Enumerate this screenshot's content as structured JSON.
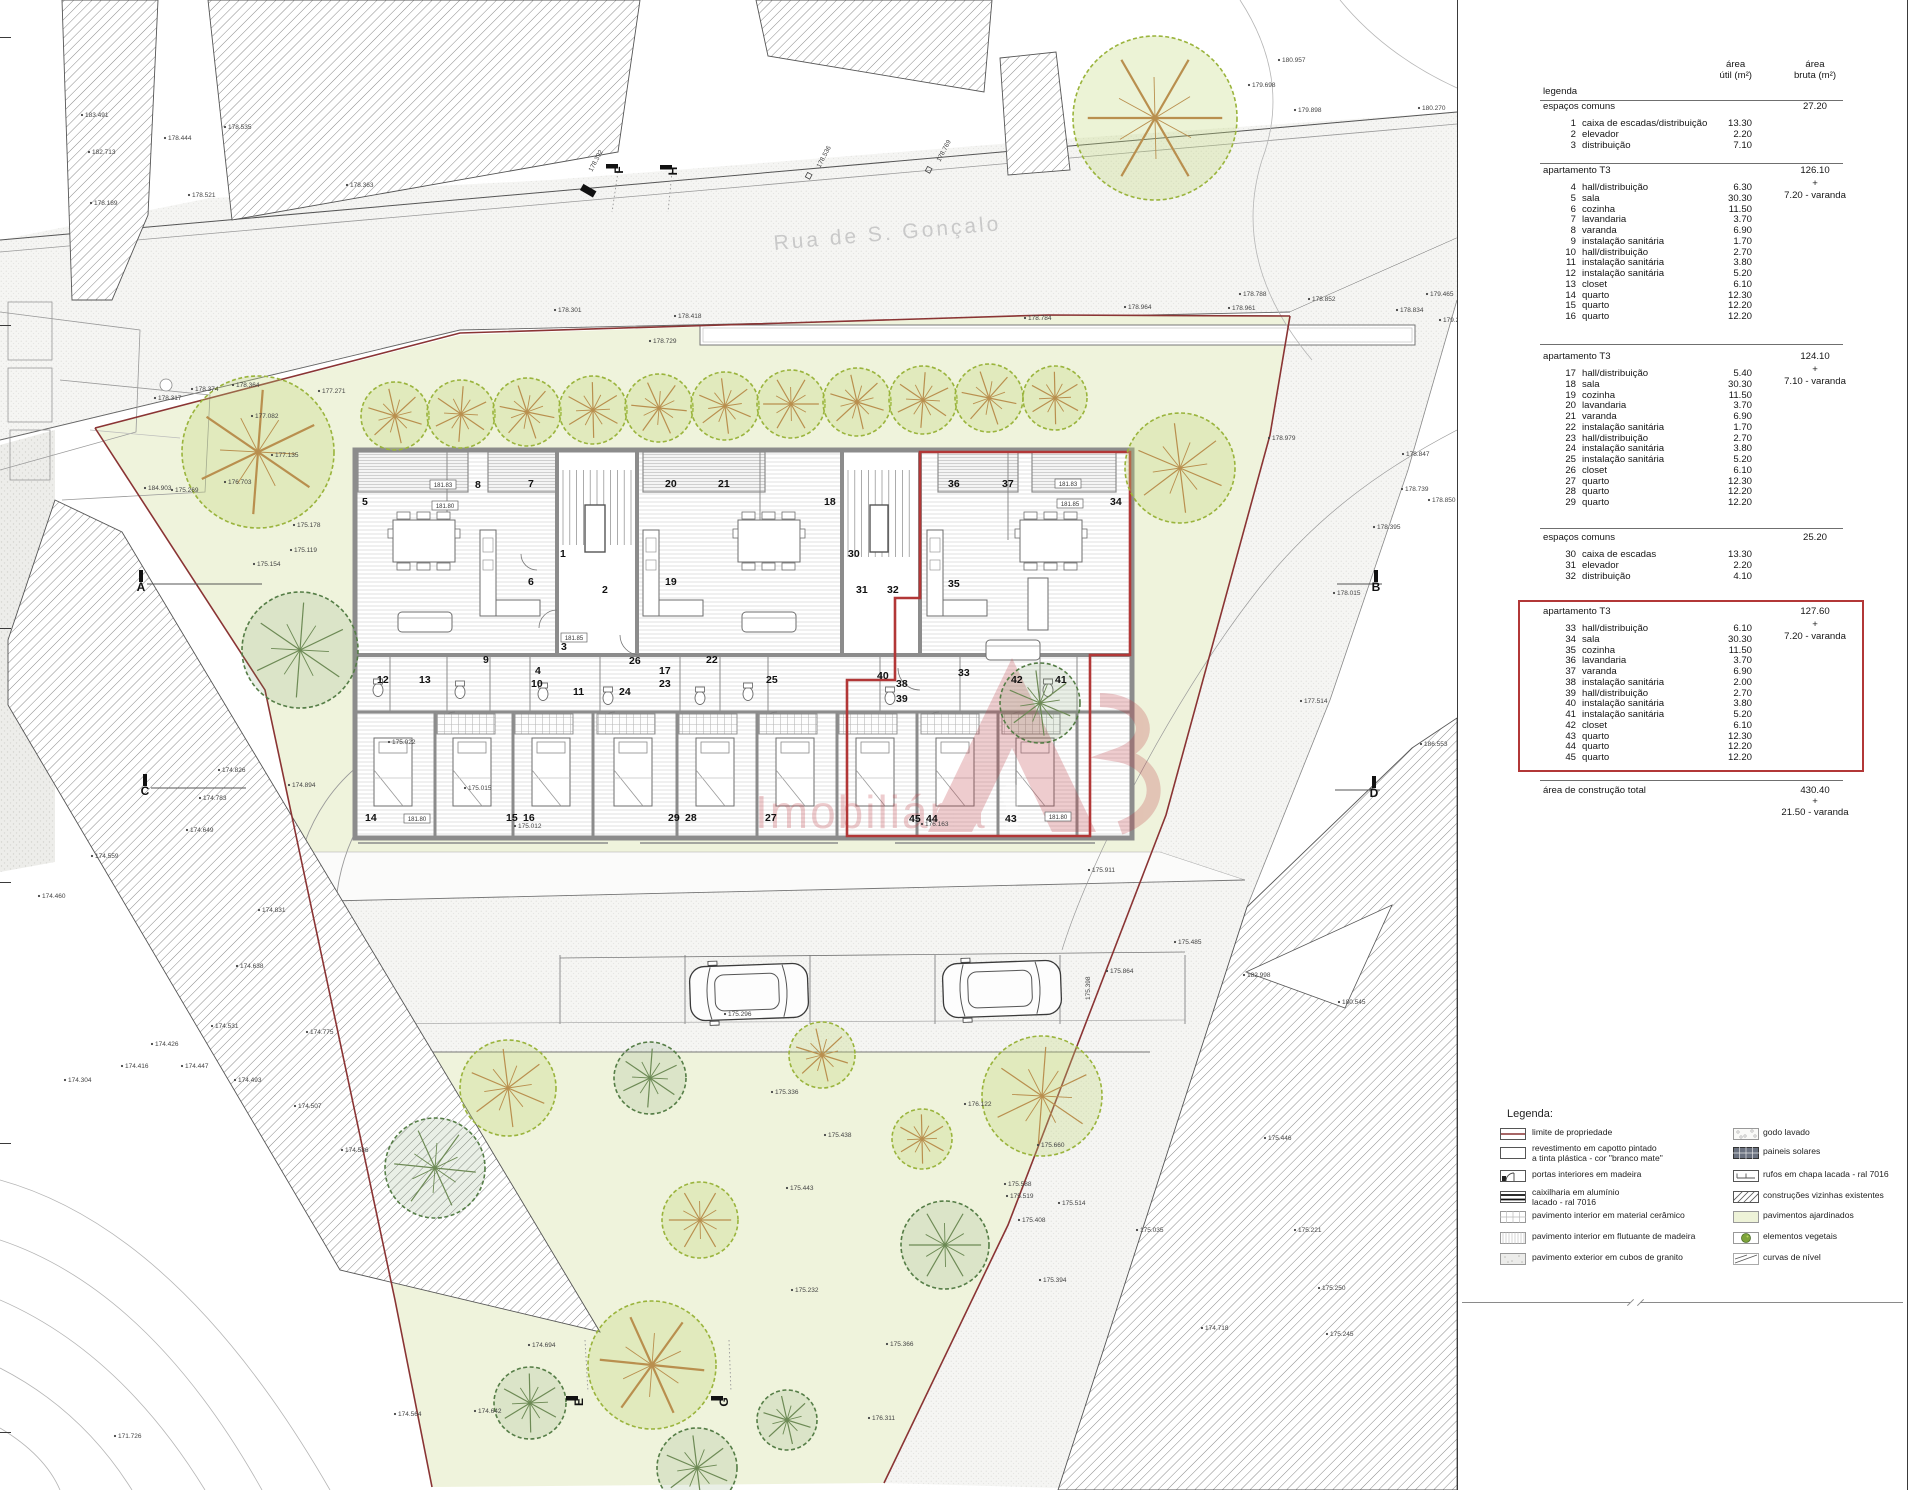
{
  "sheet": {
    "street": "Rua de S. Gonçalo",
    "watermark": "Imobiliária"
  },
  "colors": {
    "property_line": "#8a3434",
    "highlight_red": "#b23737",
    "garden_green": "#eff3dc",
    "tree_light": "#9ab43c",
    "tree_dark": "#557d46",
    "watermark_red": "#bf3d46",
    "street_gray": "#c9c9c9"
  },
  "table": {
    "title": "legenda",
    "col_util_1": "área",
    "col_util_2": "útil (m²)",
    "col_bruta_1": "área",
    "col_bruta_2": "bruta (m²)",
    "sections": [
      {
        "heading": "espaços comuns",
        "bruta": "27.20",
        "plus": "",
        "extra": "",
        "rows": [
          [
            1,
            "caixa de escadas/distribuição",
            "13.30"
          ],
          [
            2,
            "elevador",
            "2.20"
          ],
          [
            3,
            "distribuição",
            "7.10"
          ]
        ]
      },
      {
        "heading": "apartamento T3",
        "bruta": "126.10",
        "plus": "+",
        "extra": "7.20 - varanda",
        "rows": [
          [
            4,
            "hall/distribuição",
            "6.30"
          ],
          [
            5,
            "sala",
            "30.30"
          ],
          [
            6,
            "cozinha",
            "11.50"
          ],
          [
            7,
            "lavandaria",
            "3.70"
          ],
          [
            8,
            "varanda",
            "6.90"
          ],
          [
            9,
            "instalação sanitária",
            "1.70"
          ],
          [
            10,
            "hall/distribuição",
            "2.70"
          ],
          [
            11,
            "instalação sanitária",
            "3.80"
          ],
          [
            12,
            "instalação sanitária",
            "5.20"
          ],
          [
            13,
            "closet",
            "6.10"
          ],
          [
            14,
            "quarto",
            "12.30"
          ],
          [
            15,
            "quarto",
            "12.20"
          ],
          [
            16,
            "quarto",
            "12.20"
          ]
        ]
      },
      {
        "heading": "apartamento T3",
        "bruta": "124.10",
        "plus": "+",
        "extra": "7.10 - varanda",
        "rows": [
          [
            17,
            "hall/distribuição",
            "5.40"
          ],
          [
            18,
            "sala",
            "30.30"
          ],
          [
            19,
            "cozinha",
            "11.50"
          ],
          [
            20,
            "lavandaria",
            "3.70"
          ],
          [
            21,
            "varanda",
            "6.90"
          ],
          [
            22,
            "instalação sanitária",
            "1.70"
          ],
          [
            23,
            "hall/distribuição",
            "2.70"
          ],
          [
            24,
            "instalação sanitária",
            "3.80"
          ],
          [
            25,
            "instalação sanitária",
            "5.20"
          ],
          [
            26,
            "closet",
            "6.10"
          ],
          [
            27,
            "quarto",
            "12.30"
          ],
          [
            28,
            "quarto",
            "12.20"
          ],
          [
            29,
            "quarto",
            "12.20"
          ]
        ]
      },
      {
        "heading": "espaços comuns",
        "bruta": "25.20",
        "plus": "",
        "extra": "",
        "rows": [
          [
            30,
            "caixa de escadas",
            "13.30"
          ],
          [
            31,
            "elevador",
            "2.20"
          ],
          [
            32,
            "distribuição",
            "4.10"
          ]
        ]
      },
      {
        "heading": "apartamento T3",
        "bruta": "127.60",
        "plus": "+",
        "extra": "7.20 - varanda",
        "highlight": true,
        "rows": [
          [
            33,
            "hall/distribuição",
            "6.10"
          ],
          [
            34,
            "sala",
            "30.30"
          ],
          [
            35,
            "cozinha",
            "11.50"
          ],
          [
            36,
            "lavandaria",
            "3.70"
          ],
          [
            37,
            "varanda",
            "6.90"
          ],
          [
            38,
            "instalação sanitária",
            "2.00"
          ],
          [
            39,
            "hall/distribuição",
            "2.70"
          ],
          [
            40,
            "instalação sanitária",
            "3.80"
          ],
          [
            41,
            "instalação sanitária",
            "5.20"
          ],
          [
            42,
            "closet",
            "6.10"
          ],
          [
            43,
            "quarto",
            "12.30"
          ],
          [
            44,
            "quarto",
            "12.20"
          ],
          [
            45,
            "quarto",
            "12.20"
          ]
        ]
      }
    ],
    "total": {
      "label": "área de construção total",
      "value": "430.40",
      "plus": "+",
      "extra": "21.50 - varanda"
    }
  },
  "legend": {
    "title": "Legenda:",
    "left": [
      [
        "limite",
        "limite de propriedade"
      ],
      [
        "capotto",
        "revestimento em capotto pintado\na tinta plástica - cor \"branco mate\""
      ],
      [
        "portas",
        "portas interiores em madeira"
      ],
      [
        "caixilharia",
        "caixilharia em alumínio\nlacado - ral 7016"
      ],
      [
        "ceramico",
        "pavimento interior em material cerâmico"
      ],
      [
        "flutuante",
        "pavimento interior em flutuante de madeira"
      ],
      [
        "granito",
        "pavimento exterior em cubos de granito"
      ]
    ],
    "right": [
      [
        "godo",
        "godo lavado"
      ],
      [
        "solares",
        "paineis solares"
      ],
      [
        "rufos",
        "rufos em chapa lacada - ral 7016"
      ],
      [
        "construcoes",
        "construções vizinhas existentes"
      ],
      [
        "ajardinados",
        "pavimentos ajardinados"
      ],
      [
        "vegetais",
        "elementos vegetais"
      ],
      [
        "curvas",
        "curvas de nível"
      ]
    ]
  },
  "plan": {
    "rooms": [
      [
        1,
        560,
        557
      ],
      [
        2,
        602,
        593
      ],
      [
        3,
        561,
        650
      ],
      [
        4,
        535,
        674
      ],
      [
        5,
        362,
        505
      ],
      [
        6,
        528,
        585
      ],
      [
        7,
        528,
        487
      ],
      [
        8,
        475,
        488
      ],
      [
        9,
        483,
        663
      ],
      [
        10,
        531,
        687
      ],
      [
        11,
        573,
        695
      ],
      [
        12,
        377,
        683
      ],
      [
        13,
        419,
        683
      ],
      [
        14,
        365,
        821
      ],
      [
        15,
        506,
        821
      ],
      [
        16,
        523,
        821
      ],
      [
        17,
        659,
        674
      ],
      [
        18,
        824,
        505
      ],
      [
        19,
        665,
        585
      ],
      [
        20,
        665,
        487
      ],
      [
        21,
        718,
        487
      ],
      [
        22,
        706,
        663
      ],
      [
        23,
        659,
        687
      ],
      [
        24,
        619,
        695
      ],
      [
        25,
        766,
        683
      ],
      [
        26,
        629,
        664
      ],
      [
        27,
        765,
        821
      ],
      [
        28,
        685,
        821
      ],
      [
        29,
        668,
        821
      ],
      [
        30,
        848,
        557
      ],
      [
        31,
        856,
        593
      ],
      [
        32,
        887,
        593
      ],
      [
        33,
        958,
        676
      ],
      [
        34,
        1110,
        505
      ],
      [
        35,
        948,
        587
      ],
      [
        36,
        948,
        487
      ],
      [
        37,
        1002,
        487
      ],
      [
        38,
        896,
        687
      ],
      [
        39,
        896,
        702
      ],
      [
        40,
        877,
        679
      ],
      [
        41,
        1055,
        683
      ],
      [
        42,
        1011,
        683
      ],
      [
        43,
        1005,
        822
      ],
      [
        44,
        926,
        822
      ],
      [
        45,
        909,
        822
      ]
    ],
    "levels": [
      [
        "181.83",
        443,
        487
      ],
      [
        "181.80",
        445,
        508
      ],
      [
        "181.85",
        574,
        640
      ],
      [
        "181.83",
        1068,
        486
      ],
      [
        "181.85",
        1070,
        506
      ],
      [
        "181.80",
        417,
        821
      ],
      [
        "181.80",
        1058,
        819
      ]
    ],
    "markers": [
      [
        "A",
        141,
        591,
        0,
        115
      ],
      [
        "B",
        1376,
        591,
        0,
        -45
      ],
      [
        "C",
        145,
        795,
        0,
        95
      ],
      [
        "D",
        1374,
        797,
        0,
        -45
      ],
      [
        "E",
        583,
        1402,
        1,
        0
      ],
      [
        "F",
        623,
        170,
        1,
        0
      ],
      [
        "G",
        728,
        1402,
        1,
        0
      ],
      [
        "H",
        677,
        171,
        1,
        0
      ]
    ],
    "elevations": [
      [
        "183.491",
        85,
        117,
        0
      ],
      [
        "182.713",
        92,
        154,
        0
      ],
      [
        "178.444",
        168,
        140,
        0
      ],
      [
        "178.535",
        228,
        129,
        0
      ],
      [
        "178.189",
        94,
        205,
        0
      ],
      [
        "178.521",
        192,
        197,
        0
      ],
      [
        "178.363",
        350,
        187,
        0
      ],
      [
        "178.392",
        592,
        172,
        -62
      ],
      [
        "178.536",
        820,
        168,
        -62
      ],
      [
        "178.769",
        940,
        162,
        -62
      ],
      [
        "178.301",
        558,
        312,
        0
      ],
      [
        "178.418",
        678,
        318,
        0
      ],
      [
        "178.729",
        653,
        343,
        0
      ],
      [
        "178.784",
        1028,
        320,
        0
      ],
      [
        "178.964",
        1128,
        309,
        0
      ],
      [
        "178.961",
        1232,
        310,
        0
      ],
      [
        "178.788",
        1243,
        296,
        0
      ],
      [
        "178.852",
        1312,
        301,
        0
      ],
      [
        "178.834",
        1400,
        312,
        0
      ],
      [
        "179.698",
        1252,
        87,
        0
      ],
      [
        "180.957",
        1282,
        62,
        0
      ],
      [
        "180.270",
        1422,
        110,
        0
      ],
      [
        "179.898",
        1298,
        112,
        0
      ],
      [
        "179.465",
        1430,
        296,
        0
      ],
      [
        "179.231",
        1443,
        322,
        0
      ],
      [
        "177.271",
        322,
        393,
        0
      ],
      [
        "177.082",
        255,
        418,
        0
      ],
      [
        "177.135",
        275,
        457,
        0
      ],
      [
        "176.703",
        228,
        484,
        0
      ],
      [
        "184.903",
        148,
        490,
        0
      ],
      [
        "175.269",
        175,
        492,
        0
      ],
      [
        "175.178",
        297,
        527,
        0
      ],
      [
        "175.119",
        294,
        552,
        0
      ],
      [
        "175.154",
        257,
        566,
        0
      ],
      [
        "178.374",
        195,
        391,
        0
      ],
      [
        "178.364",
        236,
        387,
        0
      ],
      [
        "178.317",
        158,
        400,
        0
      ],
      [
        "178.979",
        1272,
        440,
        0
      ],
      [
        "178.847",
        1406,
        456,
        0
      ],
      [
        "178.739",
        1405,
        491,
        0
      ],
      [
        "178.850",
        1432,
        502,
        0
      ],
      [
        "178.395",
        1377,
        529,
        0
      ],
      [
        "178.015",
        1337,
        595,
        0
      ],
      [
        "177.514",
        1304,
        703,
        0
      ],
      [
        "186.553",
        1424,
        746,
        0
      ],
      [
        "182.998",
        1247,
        977,
        0
      ],
      [
        "180.545",
        1342,
        1004,
        0
      ],
      [
        "175.022",
        392,
        744,
        0
      ],
      [
        "174.894",
        292,
        787,
        0
      ],
      [
        "175.015",
        468,
        790,
        0
      ],
      [
        "175.012",
        518,
        828,
        0
      ],
      [
        "175.296",
        728,
        1016,
        0
      ],
      [
        "176.163",
        925,
        826,
        0
      ],
      [
        "175.911",
        1092,
        872,
        0
      ],
      [
        "175.864",
        1110,
        973,
        0
      ],
      [
        "175.485",
        1178,
        944,
        0
      ],
      [
        "175.398",
        1090,
        1000,
        -90
      ],
      [
        "175.336",
        775,
        1094,
        0
      ],
      [
        "175.438",
        828,
        1137,
        0
      ],
      [
        "176.122",
        968,
        1106,
        0
      ],
      [
        "175.660",
        1041,
        1147,
        0
      ],
      [
        "175.588",
        1008,
        1186,
        0
      ],
      [
        "175.443",
        790,
        1190,
        0
      ],
      [
        "175.519",
        1010,
        1198,
        0
      ],
      [
        "175.514",
        1062,
        1205,
        0
      ],
      [
        "175.408",
        1022,
        1222,
        0
      ],
      [
        "175.035",
        1140,
        1232,
        0
      ],
      [
        "175.394",
        1043,
        1282,
        0
      ],
      [
        "175.232",
        795,
        1292,
        0
      ],
      [
        "175.446",
        1268,
        1140,
        0
      ],
      [
        "175.221",
        1298,
        1232,
        0
      ],
      [
        "175.250",
        1322,
        1290,
        0
      ],
      [
        "175.245",
        1330,
        1336,
        0
      ],
      [
        "174.718",
        1205,
        1330,
        0
      ],
      [
        "174.826",
        222,
        772,
        0
      ],
      [
        "174.783",
        203,
        800,
        0
      ],
      [
        "174.649",
        190,
        832,
        0
      ],
      [
        "174.559",
        95,
        858,
        0
      ],
      [
        "174.460",
        42,
        898,
        0
      ],
      [
        "174.831",
        262,
        912,
        0
      ],
      [
        "174.638",
        240,
        968,
        0
      ],
      [
        "174.531",
        215,
        1028,
        0
      ],
      [
        "174.775",
        310,
        1034,
        0
      ],
      [
        "174.426",
        155,
        1046,
        0
      ],
      [
        "174.416",
        125,
        1068,
        0
      ],
      [
        "174.447",
        185,
        1068,
        0
      ],
      [
        "174.304",
        68,
        1082,
        0
      ],
      [
        "174.493",
        238,
        1082,
        0
      ],
      [
        "174.507",
        298,
        1108,
        0
      ],
      [
        "174.586",
        345,
        1152,
        0
      ],
      [
        "174.694",
        532,
        1347,
        0
      ],
      [
        "174.642",
        478,
        1413,
        0
      ],
      [
        "174.564",
        398,
        1416,
        0
      ],
      [
        "171.726",
        118,
        1438,
        0
      ],
      [
        "176.311",
        872,
        1420,
        0
      ],
      [
        "175.366",
        890,
        1346,
        0
      ]
    ],
    "trees": [
      [
        "L",
        395,
        416,
        34
      ],
      [
        "L",
        461,
        414,
        34
      ],
      [
        "L",
        527,
        412,
        34
      ],
      [
        "L",
        593,
        410,
        34
      ],
      [
        "L",
        659,
        408,
        34
      ],
      [
        "L",
        725,
        406,
        34
      ],
      [
        "L",
        791,
        404,
        34
      ],
      [
        "L",
        857,
        402,
        34
      ],
      [
        "L",
        923,
        400,
        34
      ],
      [
        "L",
        989,
        398,
        34
      ],
      [
        "L",
        1055,
        398,
        32
      ],
      [
        "B",
        258,
        452,
        76
      ],
      [
        "D",
        300,
        650,
        58
      ],
      [
        "B",
        1155,
        118,
        82
      ],
      [
        "L",
        1180,
        468,
        55
      ],
      [
        "D",
        1040,
        703,
        40
      ],
      [
        "L",
        822,
        1055,
        33
      ],
      [
        "L",
        1042,
        1096,
        60
      ],
      [
        "L",
        922,
        1139,
        30
      ],
      [
        "D",
        650,
        1078,
        36
      ],
      [
        "L",
        508,
        1088,
        48
      ],
      [
        "D",
        435,
        1168,
        50
      ],
      [
        "L",
        700,
        1220,
        38
      ],
      [
        "D",
        945,
        1245,
        44
      ],
      [
        "D",
        530,
        1403,
        36
      ],
      [
        "B",
        652,
        1365,
        64
      ],
      [
        "D",
        787,
        1420,
        30
      ],
      [
        "D",
        697,
        1468,
        40
      ]
    ],
    "cars": [
      [
        749,
        992
      ],
      [
        1002,
        989
      ]
    ]
  }
}
